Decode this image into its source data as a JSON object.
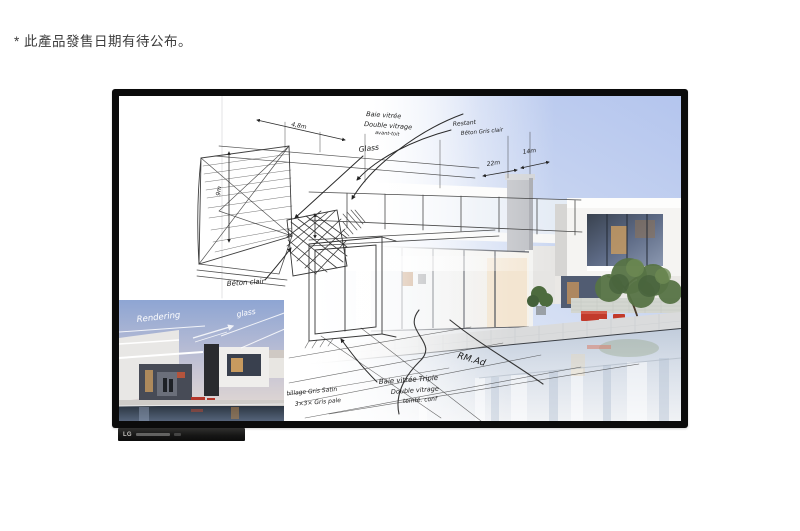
{
  "page": {
    "disclaimer": "* 此產品發售日期有待公布。"
  },
  "display": {
    "bar": {
      "logo": "LG"
    },
    "screen": {
      "dimensions": {
        "width": "4,8m",
        "height": "9m",
        "span_a": "22m",
        "span_b": "14m"
      },
      "annotations": {
        "top_center_1": "Baie vitrée",
        "top_center_2": "Double vitrage",
        "top_center_3": "avant-toit",
        "top_right_1": "Restant",
        "top_right_2": "Béton Gris clair",
        "glass": "Glass",
        "left_mid": "Béton clair",
        "pool_script": "RM.Ad",
        "bottom_center_1": "Baie vitrée Triple",
        "bottom_center_2": "Double vitrage",
        "bottom_center_3": "teinté. conf",
        "bottom_left_1": "habillage Gris Satin",
        "bottom_left_2": "3×3× Gris pale"
      },
      "inset": {
        "title": "Rendering",
        "label": "glass"
      },
      "colors": {
        "sky_top": "#b4c5ee",
        "pool_light": "#d8dfe9",
        "accent_red": "#c23a2b",
        "dusk_sky": "#8ea5d3",
        "bezel": "#0b0b0b"
      }
    }
  }
}
